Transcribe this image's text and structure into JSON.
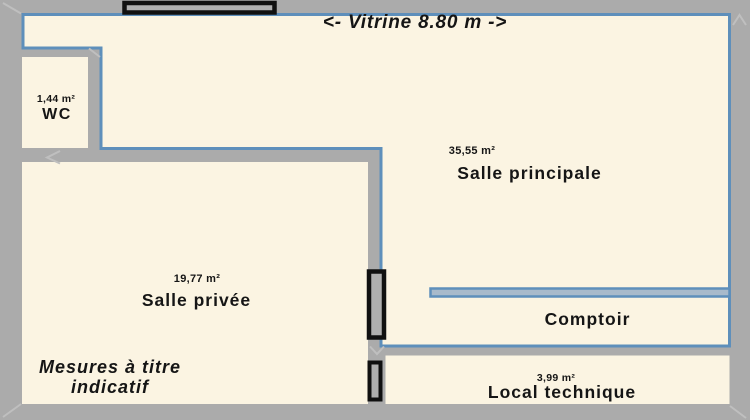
{
  "plan_title": "Commercial space floor plan",
  "annotations": {
    "vitrine": "<- Vitrine 8.80 m ->",
    "disclaimer_line1": "Mesures à titre",
    "disclaimer_line2": "indicatif"
  },
  "rooms": {
    "wc": {
      "name": "WC",
      "area": "1,44 m²"
    },
    "main": {
      "name": "Salle principale",
      "area": "35,55 m²"
    },
    "private": {
      "name": "Salle privée",
      "area": "19,77 m²"
    },
    "counter": {
      "name": "Comptoir"
    },
    "technical": {
      "name": "Local technique",
      "area": "3,99 m²"
    }
  },
  "colors": {
    "wall": "#ABABAB",
    "floor": "#FBF4E2",
    "outline": "#5E8FBB",
    "door_fill": "#AFAFAF",
    "frame_black": "#101010",
    "bevel": "#BFBFBF",
    "counter_fill": "#A8BACB",
    "text": "#151515"
  }
}
